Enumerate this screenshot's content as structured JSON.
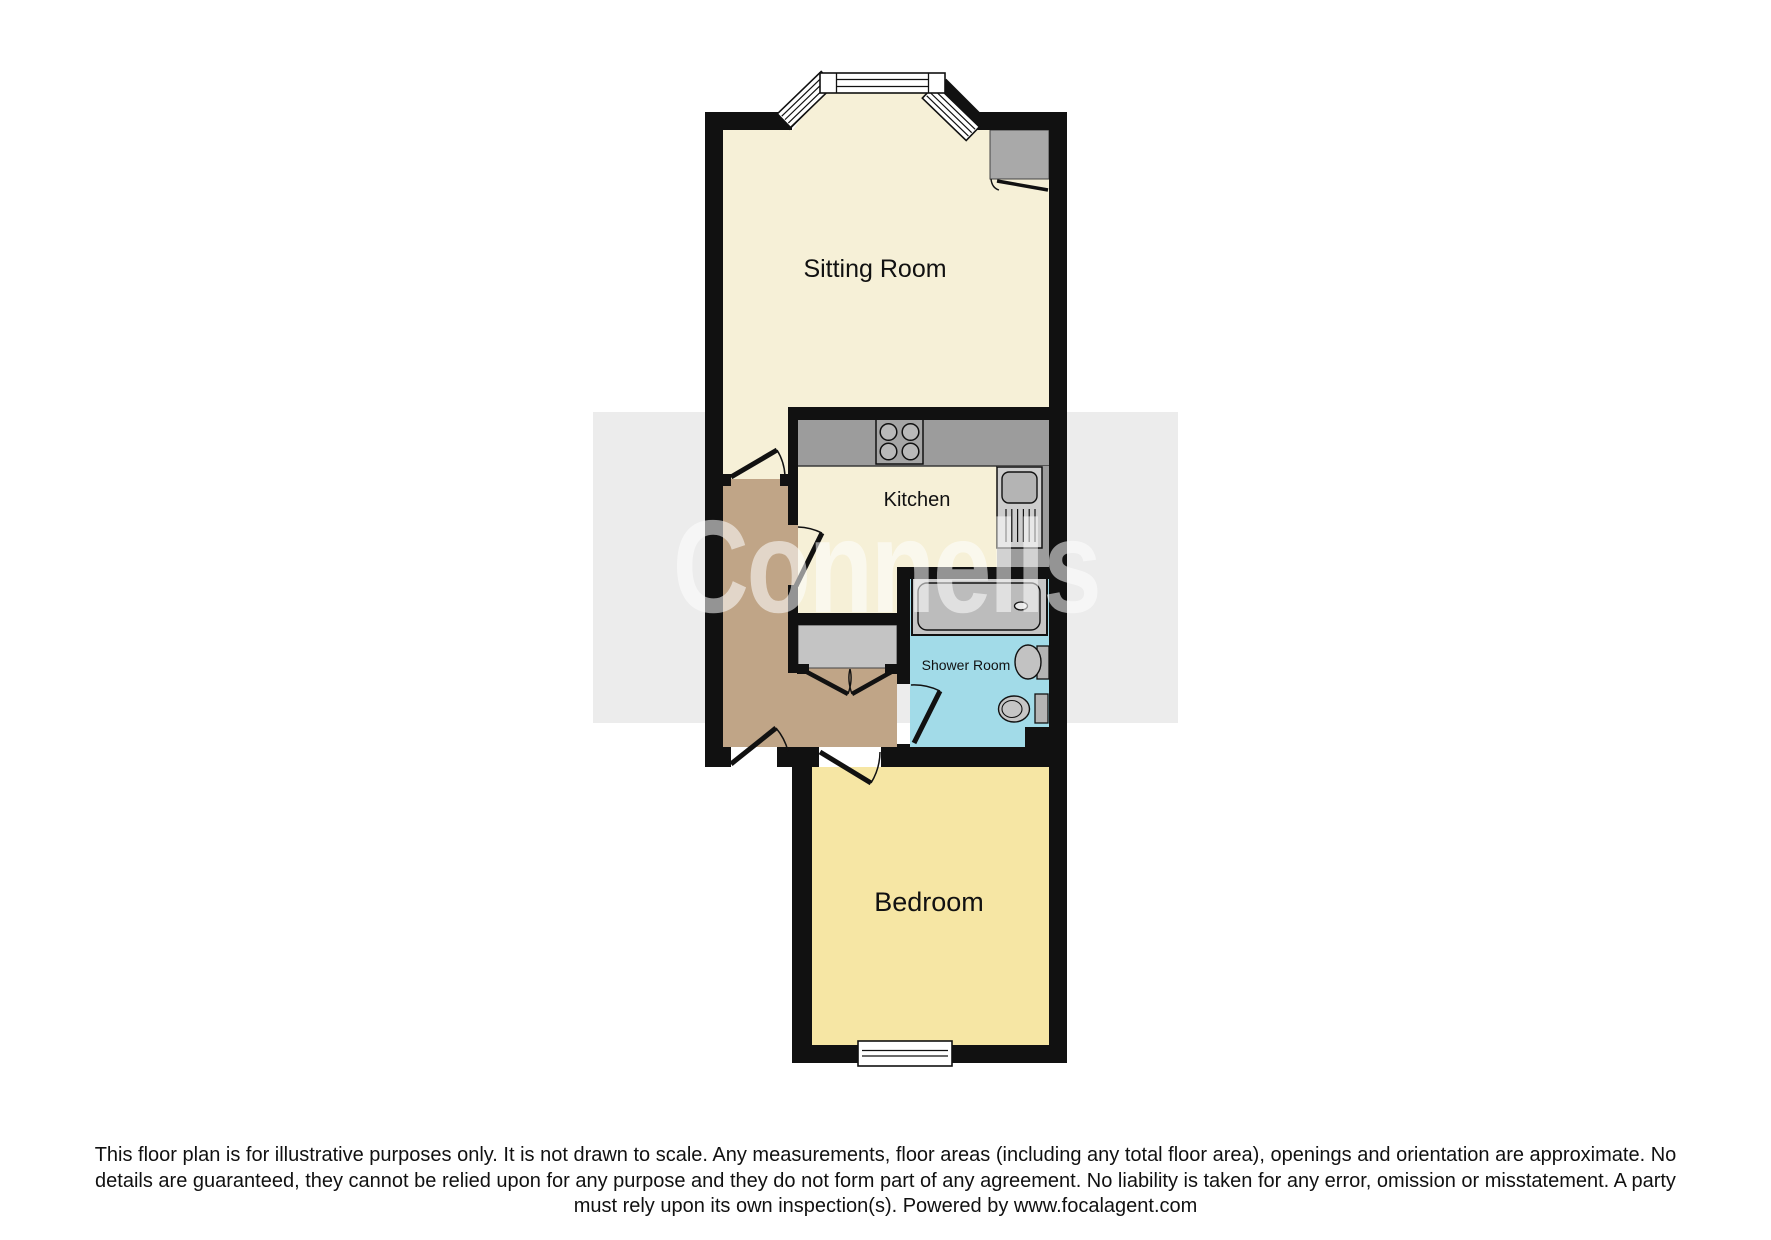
{
  "plan": {
    "rooms": [
      {
        "id": "sitting-room",
        "label": "Sitting Room"
      },
      {
        "id": "kitchen",
        "label": "Kitchen"
      },
      {
        "id": "shower-room",
        "label": "Shower Room"
      },
      {
        "id": "bedroom",
        "label": "Bedroom"
      }
    ],
    "fixtures": [
      "bay-window",
      "chimney-cupboard",
      "hob",
      "kitchen-sink-drainer",
      "hall-cupboard",
      "shower-tray",
      "wash-basin",
      "toilet",
      "bedroom-window"
    ]
  },
  "watermark": {
    "text": "Connells"
  },
  "disclaimer": {
    "lines": [
      "This floor plan is for illustrative purposes only. It is not drawn to scale. Any measurements, floor areas (including any total floor area), openings and orientation are approximate. No",
      "details are guaranteed, they cannot be relied upon for any purpose and they do not form part of any agreement. No liability is taken for any error, omission or misstatement. A party",
      "must rely upon its own inspection(s). Powered by www.focalagent.com"
    ]
  },
  "colors": {
    "wall": "#111111",
    "sitting_room_floor": "#f6f0d7",
    "kitchen_floor": "#f6f0d7",
    "bedroom_floor": "#f6e6a4",
    "shower_room_floor": "#a2dbe8",
    "hallway_floor": "#c0a587",
    "counter_gray": "#9c9c9c",
    "fixture_gray": "#c4c4c4",
    "watermark_band": "#ececec",
    "watermark_text": "#ffffff",
    "disclaimer_text": "#111111"
  }
}
